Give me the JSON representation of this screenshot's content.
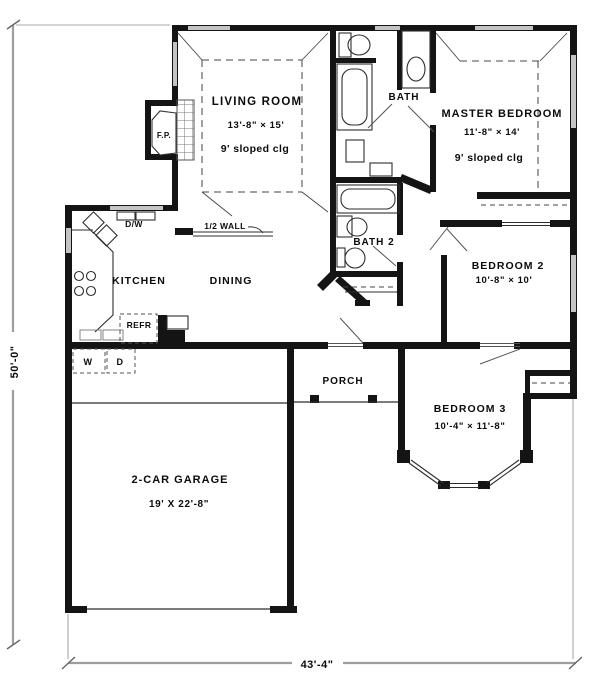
{
  "plan": {
    "rooms": {
      "living": {
        "name": "LIVING ROOM",
        "size": "13'-8\" × 15'",
        "note": "9' sloped clg"
      },
      "master": {
        "name": "MASTER BEDROOM",
        "size": "11'-8\" × 14'",
        "note": "9' sloped clg"
      },
      "bath": {
        "name": "BATH"
      },
      "bath2": {
        "name": "BATH 2"
      },
      "kitchen": {
        "name": "KITCHEN"
      },
      "dining": {
        "name": "DINING"
      },
      "bedroom2": {
        "name": "BEDROOM 2",
        "size": "10'-8\" × 10'"
      },
      "bedroom3": {
        "name": "BEDROOM 3",
        "size": "10'-4\" × 11'-8\""
      },
      "porch": {
        "name": "PORCH"
      },
      "garage": {
        "name": "2-CAR GARAGE",
        "size": "19' X 22'-8\""
      }
    },
    "annotations": {
      "fireplace": "F.P.",
      "dishwasher": "D/W",
      "half_wall": "1/2 WALL",
      "refrigerator": "REFR",
      "washer": "W",
      "dryer": "D"
    },
    "dimensions": {
      "overall_width": "43'-4\"",
      "overall_depth": "50'-0\""
    }
  }
}
